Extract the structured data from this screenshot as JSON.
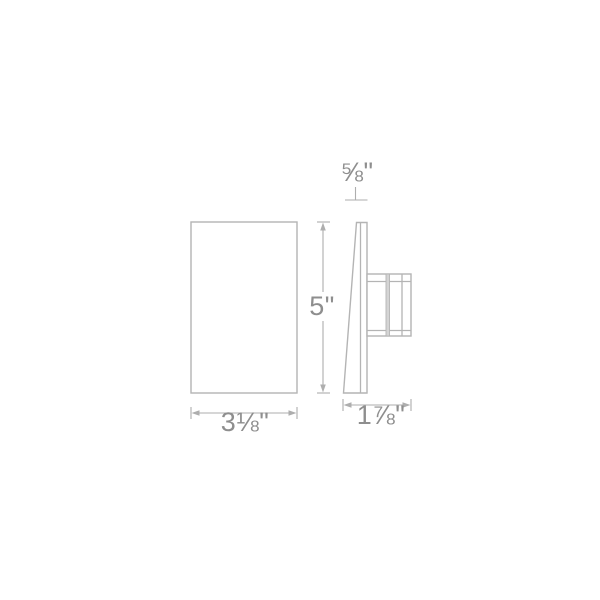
{
  "colors": {
    "outline": "#b4b4b4",
    "dimension_line": "#aeaeae",
    "label_text": "#8e8e8e",
    "band_fill": "#d4d4d4",
    "background": "#ffffff"
  },
  "drawing": {
    "front_view": {
      "height_label": "5\"",
      "width_label": "3⅛\""
    },
    "side_view": {
      "top_depth_label": "⅝\"",
      "depth_label": "1⅞\""
    }
  }
}
